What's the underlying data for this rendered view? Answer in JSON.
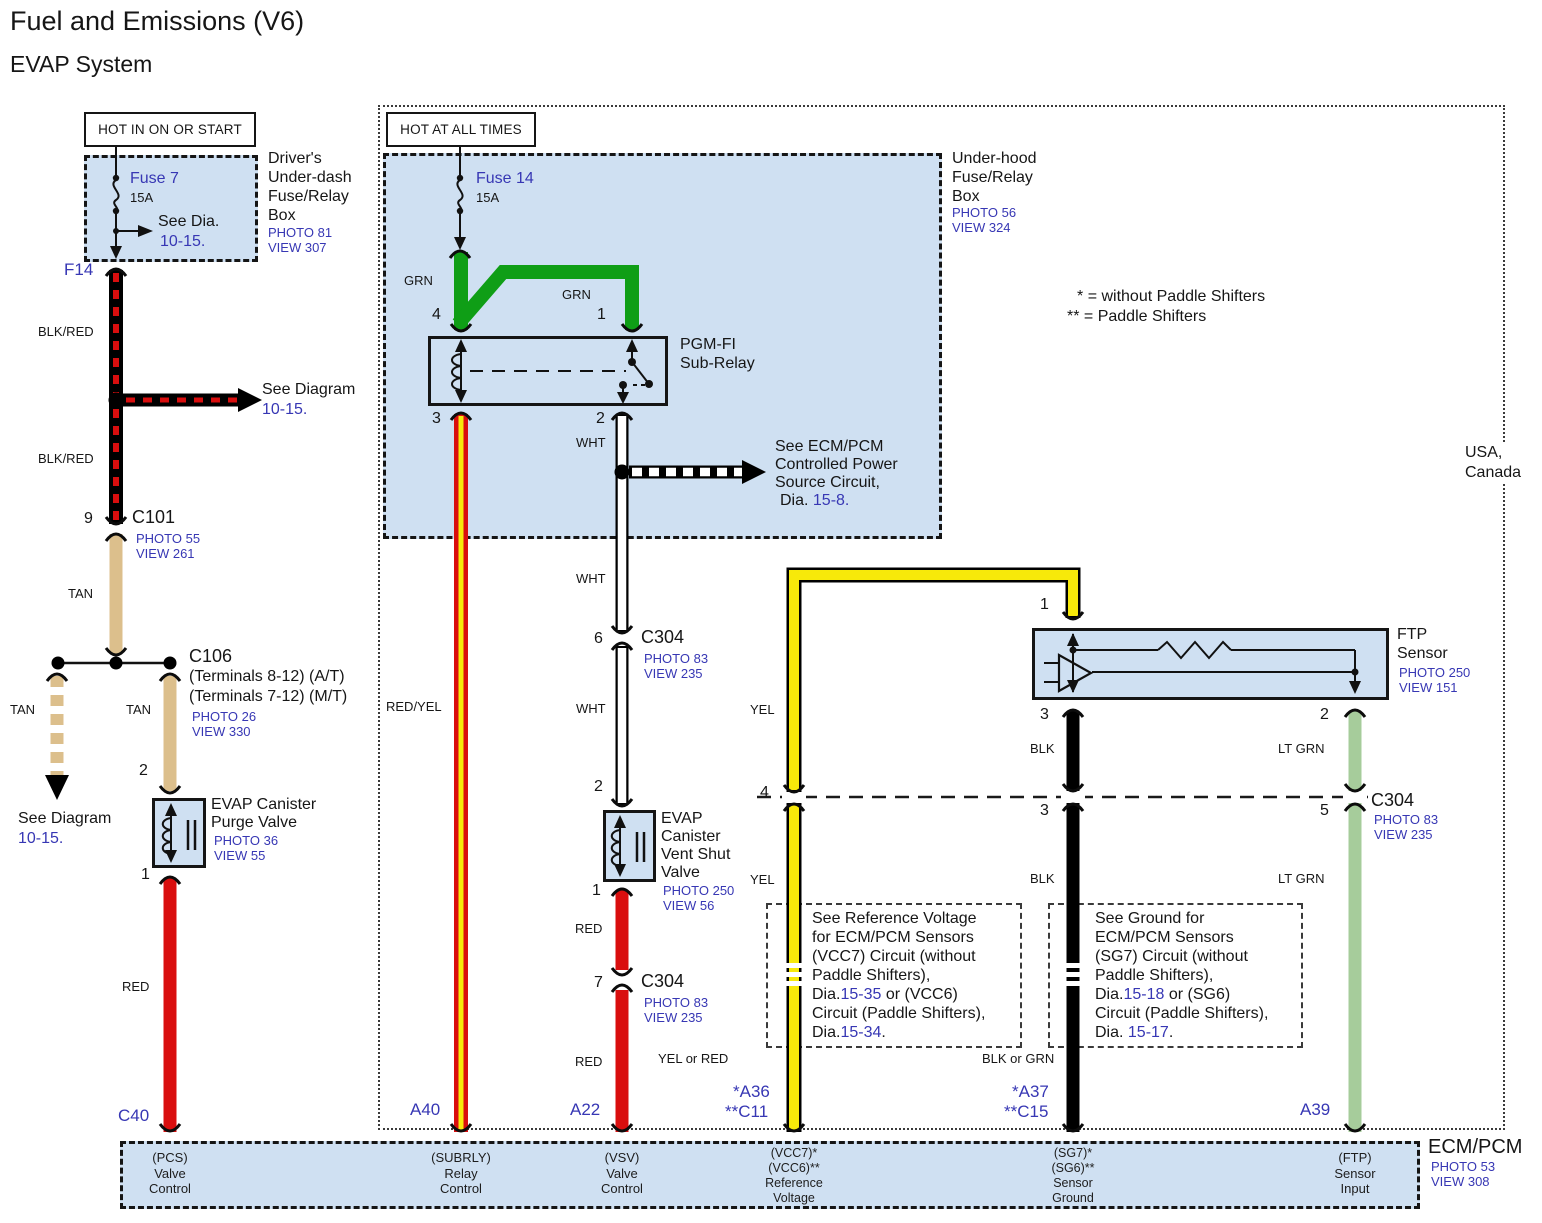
{
  "page": {
    "title": "Fuel and Emissions (V6)",
    "subtitle": "EVAP System",
    "region_line1": "USA,",
    "region_line2": "Canada",
    "legend_star1": "*",
    "legend_text1": "=  without Paddle Shifters",
    "legend_star2": "**",
    "legend_text2": "=  Paddle Shifters"
  },
  "banners": {
    "left": "HOT IN ON OR START",
    "mid": "HOT AT ALL TIMES"
  },
  "driver_box": {
    "l1": "Driver's",
    "l2": "Under-dash",
    "l3": "Fuse/Relay",
    "l4": "Box",
    "photo": "PHOTO 81",
    "view": "VIEW 307",
    "fuse": "Fuse 7",
    "amps": "15A",
    "see": "See Dia.",
    "see_link": "10-15.",
    "connector": "F14"
  },
  "underhood_box": {
    "l1": "Under-hood",
    "l2": "Fuse/Relay",
    "l3": "Box",
    "photo": "PHOTO 56",
    "view": "VIEW 324",
    "fuse": "Fuse 14",
    "amps": "15A"
  },
  "relay": {
    "l1": "PGM-FI",
    "l2": "Sub-Relay",
    "pin_tl": "4",
    "pin_tr": "1",
    "pin_bl": "3",
    "pin_br": "2"
  },
  "left_branch": {
    "wire1": "BLK/RED",
    "wire2": "BLK/RED",
    "see_diagram": "See Diagram",
    "see_link": "10-15.",
    "c101_pin": "9",
    "c101": "C101",
    "c101_photo": "PHOTO 55",
    "c101_view": "VIEW 261",
    "tan1": "TAN",
    "tan2": "TAN",
    "c106": "C106",
    "c106_l1": "(Terminals 8-12) (A/T)",
    "c106_l2": "(Terminals 7-12) (M/T)",
    "c106_photo": "PHOTO 26",
    "c106_view": "VIEW 330",
    "see_diagram2": "See Diagram",
    "see_link2": "10-15.",
    "purge_pin_top": "2",
    "purge_l1": "EVAP Canister",
    "purge_l2": "Purge Valve",
    "purge_photo": "PHOTO 36",
    "purge_view": "VIEW 55",
    "purge_pin_bottom": "1",
    "red": "RED",
    "connector": "C40"
  },
  "mid_branch": {
    "grn1": "GRN",
    "grn2": "GRN",
    "redyel": "RED/YEL",
    "a40": "A40",
    "wht1": "WHT",
    "wht2": "WHT",
    "wht3": "WHT",
    "see_ecm_l1": "See ECM/PCM",
    "see_ecm_l2": "Controlled Power",
    "see_ecm_l3": "Source Circuit,",
    "see_ecm_l4": "Dia. ",
    "see_ecm_link": "15-8.",
    "c304a_pin": "6",
    "c304a": "C304",
    "c304a_photo": "PHOTO 83",
    "c304a_view": "VIEW 235",
    "vent_pin_top": "2",
    "vent_l1": "EVAP",
    "vent_l2": "Canister",
    "vent_l3": "Vent Shut",
    "vent_l4": "Valve",
    "vent_photo": "PHOTO 250",
    "vent_view": "VIEW 56",
    "vent_pin_bottom": "1",
    "red1": "RED",
    "c304b_pin": "7",
    "c304b": "C304",
    "c304b_photo": "PHOTO 83",
    "c304b_view": "VIEW 235",
    "red2": "RED",
    "a22": "A22"
  },
  "right_branch": {
    "yel1": "YEL",
    "yel2": "YEL",
    "yel_or_red": "YEL or RED",
    "a36": "*A36",
    "c11": "**C11",
    "ftp_pin_top": "1",
    "ftp_l1": "FTP",
    "ftp_l2": "Sensor",
    "ftp_photo": "PHOTO 250",
    "ftp_view": "VIEW 151",
    "ftp_pin_bl": "3",
    "ftp_pin_br": "2",
    "blk1": "BLK",
    "blk2": "BLK",
    "blk_or_grn": "BLK or GRN",
    "a37": "*A37",
    "c15": "**C15",
    "ltgrn1": "LT GRN",
    "ltgrn2": "LT GRN",
    "a39": "A39",
    "c304_pin4": "4",
    "c304_pin3": "3",
    "c304_pin5": "5",
    "c304": "C304",
    "c304_photo": "PHOTO 83",
    "c304_view": "VIEW 235"
  },
  "ref_box": {
    "l1": "See Reference Voltage",
    "l2": "for ECM/PCM Sensors",
    "l3": "(VCC7) Circuit (without",
    "l4": "Paddle Shifters),",
    "l5a": "Dia.",
    "l5b": "15-35",
    "l5c": " or (VCC6)",
    "l6": "Circuit (Paddle Shifters),",
    "l7a": "Dia.",
    "l7b": "15-34",
    "l7c": "."
  },
  "gnd_box": {
    "l1": "See Ground for",
    "l2": "ECM/PCM Sensors",
    "l3": "(SG7) Circuit (without",
    "l4": "Paddle Shifters),",
    "l5a": "Dia.",
    "l5b": "15-18",
    "l5c": " or (SG6)",
    "l6": "Circuit (Paddle Shifters),",
    "l7a": "Dia. ",
    "l7b": "15-17",
    "l7c": "."
  },
  "ecm": {
    "name": "ECM/PCM",
    "photo": "PHOTO 53",
    "view": "VIEW 308",
    "t1_l1": "(PCS)",
    "t1_l2": "Valve",
    "t1_l3": "Control",
    "t2_l1": "(SUBRLY)",
    "t2_l2": "Relay",
    "t2_l3": "Control",
    "t3_l1": "(VSV)",
    "t3_l2": "Valve",
    "t3_l3": "Control",
    "t4_l1": "(VCC7)*",
    "t4_l2": "(VCC6)**",
    "t4_l3": "Reference",
    "t4_l4": "Voltage",
    "t5_l1": "(SG7)*",
    "t5_l2": "(SG6)**",
    "t5_l3": "Sensor",
    "t5_l4": "Ground",
    "t6_l1": "(FTP)",
    "t6_l2": "Sensor",
    "t6_l3": "Input"
  },
  "colors": {
    "box_fill": "#cfe0f2",
    "link": "#3737b4",
    "red": "#d90e0e",
    "tan": "#dcbf8c",
    "green": "#0f9e16",
    "yellow": "#f7e90a",
    "lt_green": "#a6cc9b",
    "black": "#000000"
  }
}
